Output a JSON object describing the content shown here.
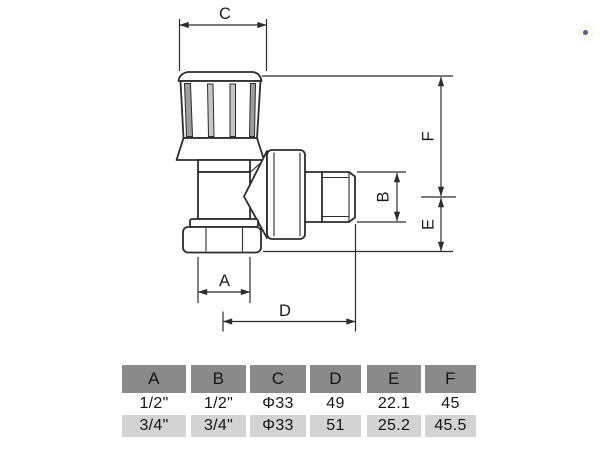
{
  "drawing": {
    "dim_labels": {
      "C": "C",
      "F": "F",
      "B": "B",
      "E": "E",
      "A": "A",
      "D": "D"
    }
  },
  "table": {
    "headers": [
      "A",
      "B",
      "C",
      "D",
      "E",
      "F"
    ],
    "rows": [
      [
        "1/2\"",
        "1/2\"",
        "Φ33",
        "49",
        "22.1",
        "45"
      ],
      [
        "3/4\"",
        "3/4\"",
        "Φ33",
        "51",
        "25.2",
        "45.5"
      ]
    ]
  },
  "colors": {
    "table_header_bg": "#8a8a8a",
    "table_alt_row_bg": "#d3d3d3",
    "line_color": "#2c2c2c"
  }
}
